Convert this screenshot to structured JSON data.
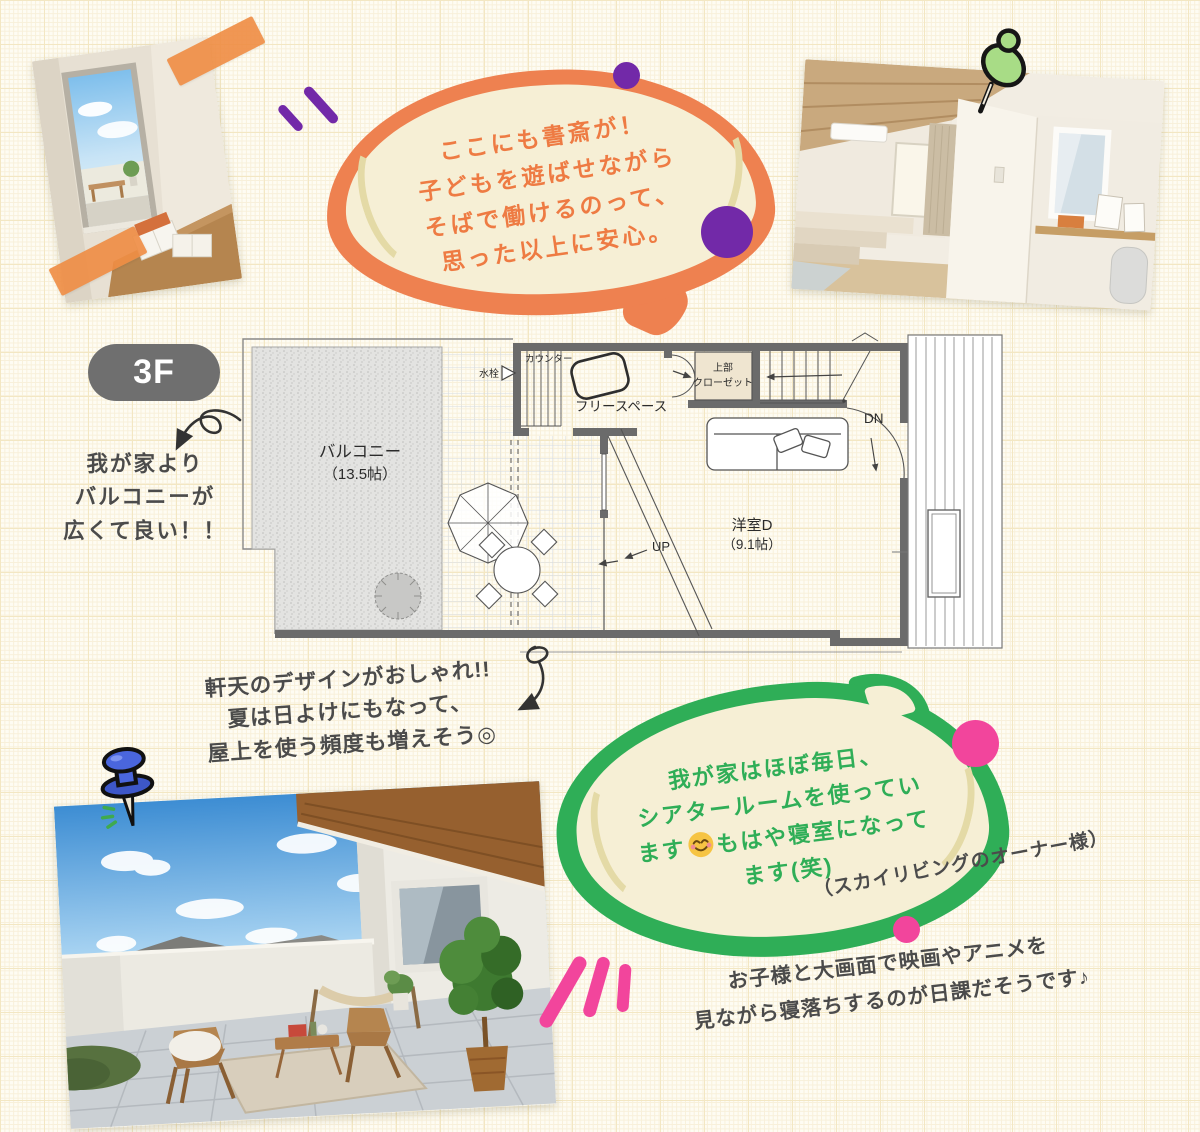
{
  "colors": {
    "orange": "#ee8150",
    "orange_text": "#ee7b43",
    "purple": "#7229a8",
    "green": "#2fae57",
    "pink": "#f2459c",
    "cream": "#f6efd5",
    "ink": "#4b4b4b"
  },
  "badge": {
    "label": "3F"
  },
  "orange_bubble": {
    "lines": [
      "ここにも書斎が！",
      "子どもを遊ばせながら",
      "そばで働けるのって、",
      "思った以上に安心。"
    ]
  },
  "balcony_note": {
    "lines": [
      "我が家より",
      "バルコニーが",
      "広くて良い！！"
    ]
  },
  "eaves_note": {
    "lines": [
      "軒天のデザインがおしゃれ!!",
      "夏は日よけにもなって、",
      "屋上を使う頻度も増えそう◎"
    ]
  },
  "green_bubble": {
    "line1": "我が家はほぼ毎日、",
    "line2": "シアタールームを使ってい",
    "line3_before": "ます",
    "line3_after": "もはや寝室になって",
    "line4": "ます(笑)",
    "emoji": "smiling-face-with-blush"
  },
  "owner_note": "（スカイリビングのオーナー様）",
  "bottom_note": {
    "lines": [
      "お子様と大画面で映画やアニメを",
      "見ながら寝落ちするのが日課だそうです♪"
    ]
  },
  "floor_plan": {
    "balcony": "バルコニー",
    "balcony_size": "（13.5帖）",
    "faucet": "水栓",
    "counter": "カウンター",
    "free_space": "フリースペース",
    "closet_line1": "上部",
    "closet_line2": "クローゼット",
    "down": "DN",
    "up": "UP",
    "room": "洋室D",
    "room_size": "（9.1帖）"
  }
}
